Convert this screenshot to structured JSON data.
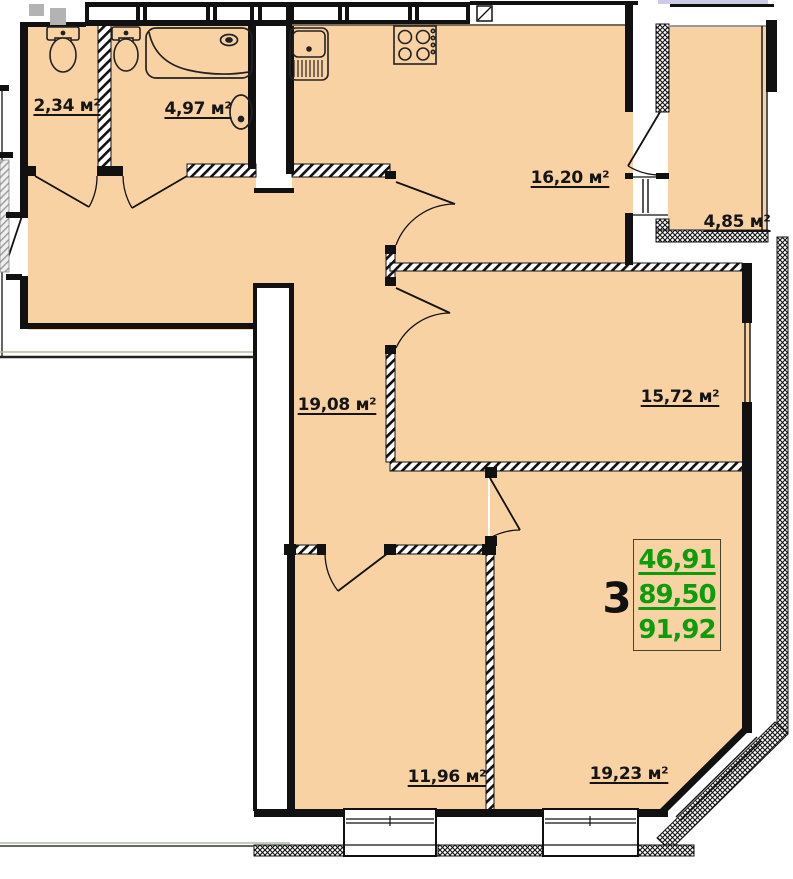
{
  "plan": {
    "unit_number": "3",
    "summary": {
      "values": [
        "46,91",
        "89,50",
        "91,92"
      ]
    },
    "rooms": [
      {
        "id": "wc",
        "area_label": "2,34 м²"
      },
      {
        "id": "bathroom",
        "area_label": "4,97 м²"
      },
      {
        "id": "kitchen",
        "area_label": "16,20 м²"
      },
      {
        "id": "balcony",
        "area_label": "4,85 м²"
      },
      {
        "id": "hallway",
        "area_label": "19,08 м²"
      },
      {
        "id": "bedroom",
        "area_label": "15,72 м²"
      },
      {
        "id": "child-room",
        "area_label": "11,96 м²"
      },
      {
        "id": "living-room",
        "area_label": "19,23 м²"
      }
    ],
    "colors": {
      "room_fill": "#F9D2A4",
      "wall": "#111111",
      "summary_green": "#0C9C0C",
      "lavender_strip": "#CBCBE8",
      "vent_gray": "#B3B3B3",
      "outline_green": "#AEBFA0"
    }
  }
}
